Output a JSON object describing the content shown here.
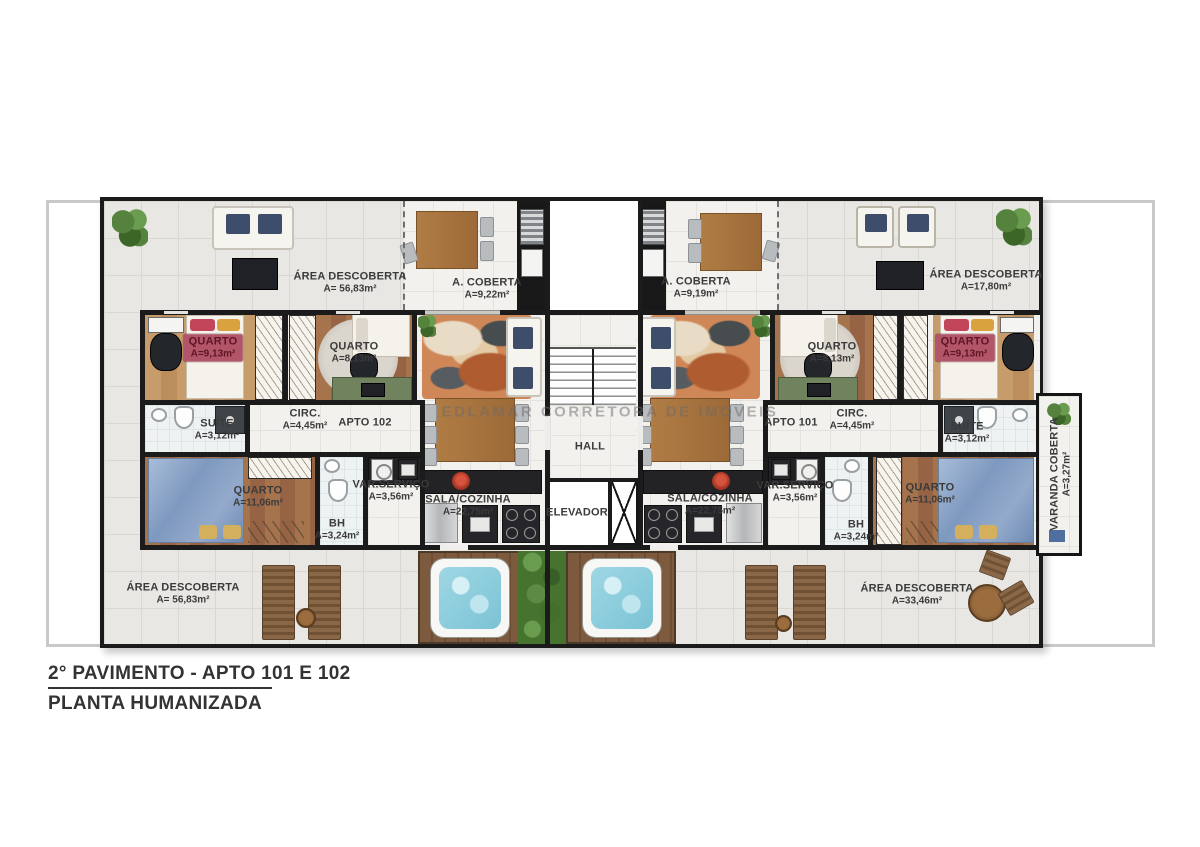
{
  "title_block": {
    "line1": "2° PAVIMENTO - APTO 101 E 102",
    "line2": "PLANTA HUMANIZADA"
  },
  "watermark": "EDLAMAR CORRETORA DE IMOVEIS",
  "apartments": {
    "left_id": "APTO 102",
    "right_id": "APTO 101"
  },
  "center": {
    "hall": "HALL",
    "elevador": "ELEVADOR"
  },
  "rooms": {
    "area_descoberta_tl": {
      "name": "ÁREA DESCOBERTA",
      "area": "A= 56,83m²"
    },
    "a_coberta_l": {
      "name": "A. COBERTA",
      "area": "A=9,22m²"
    },
    "a_coberta_r": {
      "name": "A. COBERTA",
      "area": "A=9,19m²"
    },
    "area_descoberta_tr": {
      "name": "ÁREA DESCOBERTA",
      "area": "A=17,80m²"
    },
    "quarto913_l": {
      "name": "QUARTO",
      "area": "A=9,13m²"
    },
    "quarto813_l": {
      "name": "QUARTO",
      "area": "A=8,13m²"
    },
    "quarto813_r": {
      "name": "QUARTO",
      "area": "A=8,13m²"
    },
    "quarto913_r": {
      "name": "QUARTO",
      "area": "A=9,13m²"
    },
    "suite_l": {
      "name": "SUÍTE",
      "area": "A=3,12m²"
    },
    "suite_r": {
      "name": "SUÍTE",
      "area": "A=3,12m²"
    },
    "circ_l": {
      "name": "CIRC.",
      "area": "A=4,45m²"
    },
    "circ_r": {
      "name": "CIRC.",
      "area": "A=4,45m²"
    },
    "quarto1106_l": {
      "name": "QUARTO",
      "area": "A=11,06m²"
    },
    "quarto1106_r": {
      "name": "QUARTO",
      "area": "A=11,06m²"
    },
    "var_servico_l": {
      "name": "VAR.SERVIÇO",
      "area": "A=3,56m²"
    },
    "var_servico_r": {
      "name": "VAR.SERVIÇO",
      "area": "A=3,56m²"
    },
    "bh_l": {
      "name": "BH",
      "area": "A=3,24m²"
    },
    "bh_r": {
      "name": "BH",
      "area": "A=3,24m²"
    },
    "sala_cozinha_l": {
      "name": "SALA/COZINHA",
      "area": "A=22,75m²"
    },
    "sala_cozinha_r": {
      "name": "SALA/COZINHA",
      "area": "A=22,75m²"
    },
    "varanda": {
      "name": "VARANDA COBERTA",
      "area": "A=3,27m²"
    },
    "area_descoberta_bl": {
      "name": "ÁREA DESCOBERTA",
      "area": "A= 56,83m²"
    },
    "area_descoberta_br": {
      "name": "ÁREA DESCOBERTA",
      "area": "A=33,46m²"
    }
  },
  "colors": {
    "wall": "#1b1b1b",
    "terrace_tile": "#e8e7e4",
    "quarto_label_bg": "#b25568",
    "pool_water": "#8fd0e0",
    "deck_wood": "#7d5a3d",
    "plant_green": "#46742f"
  }
}
